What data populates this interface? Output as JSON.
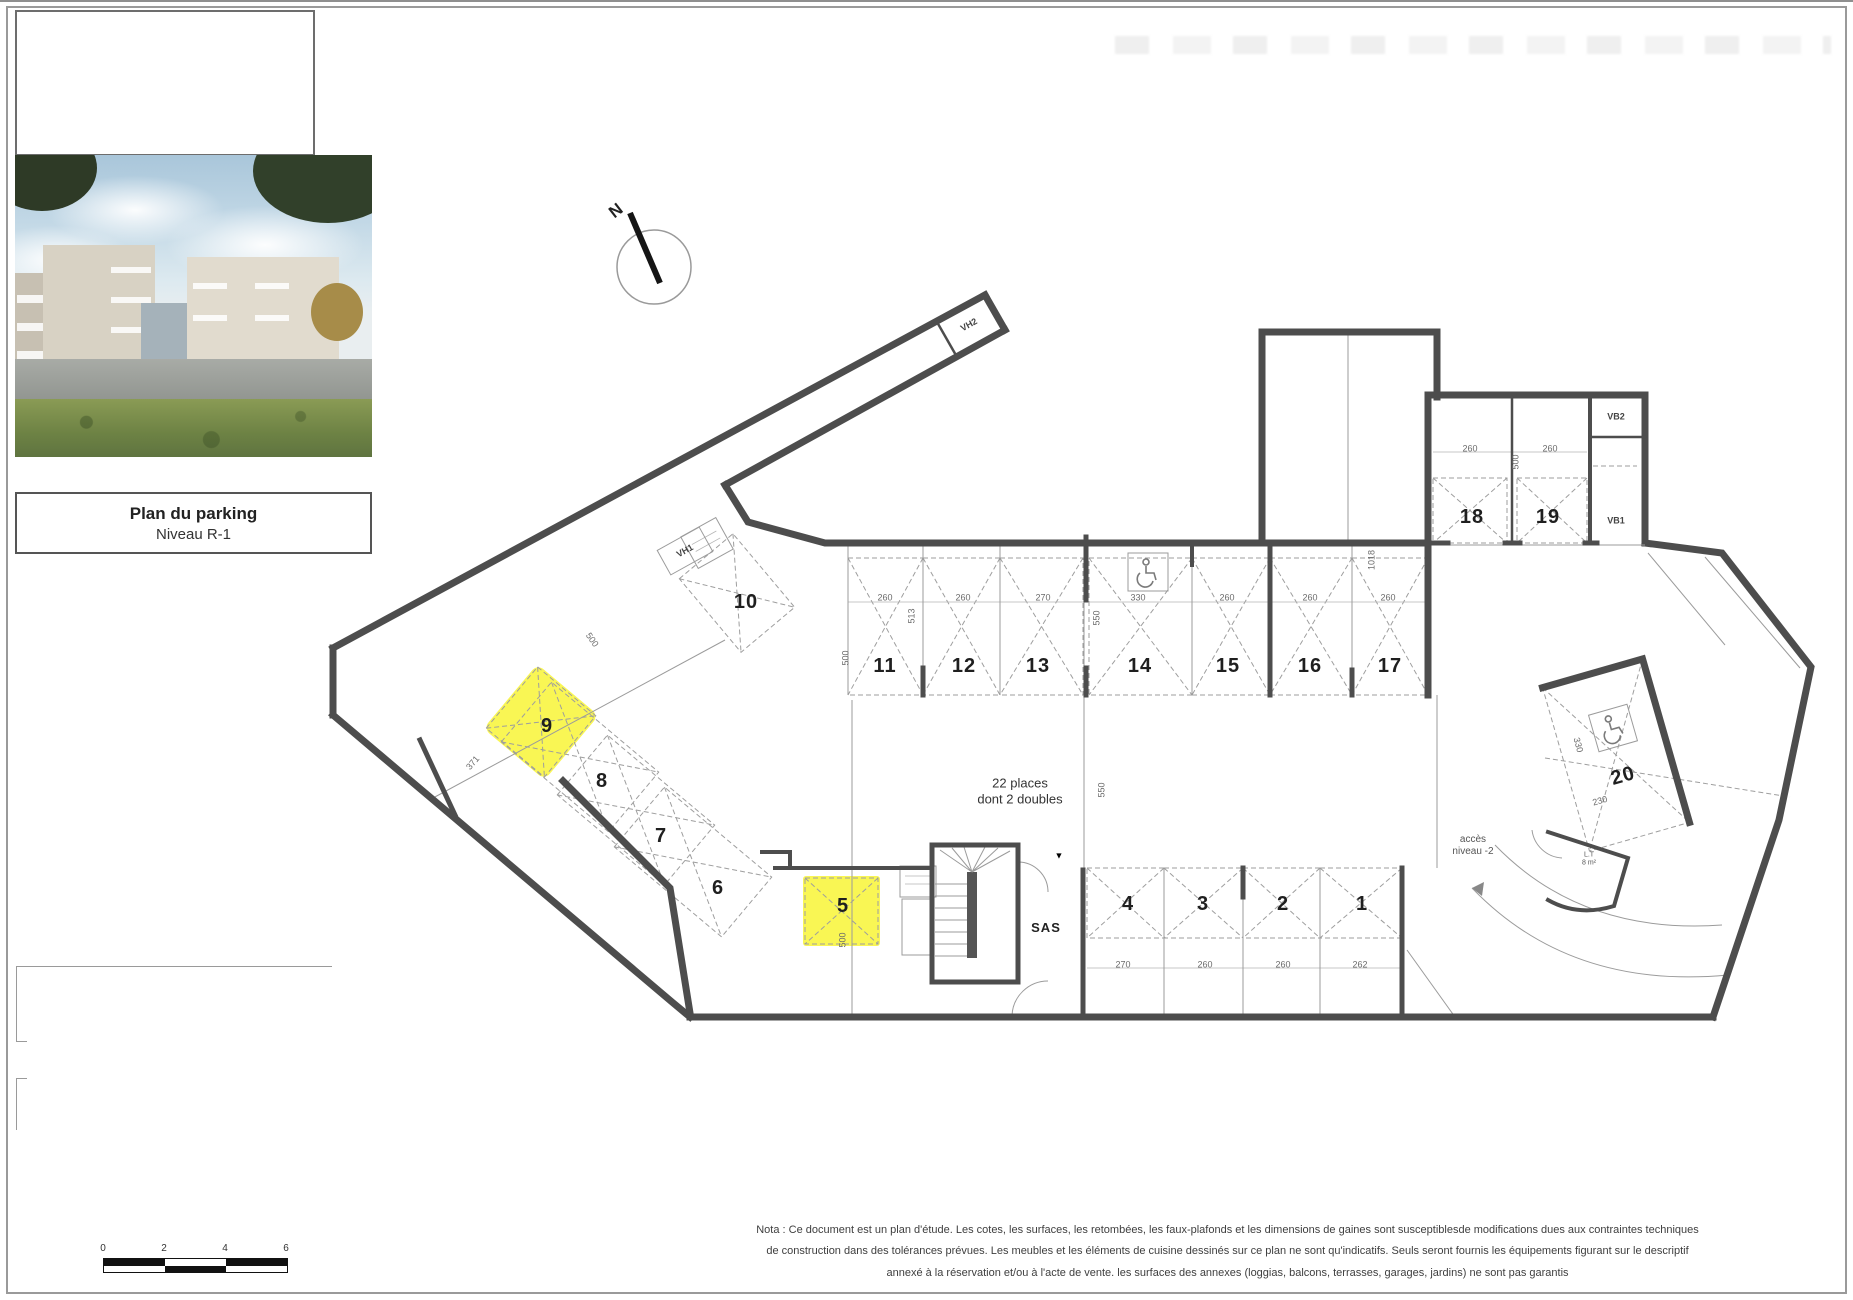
{
  "title_block": {
    "line1": "Plan du parking",
    "line2": "Niveau R-1"
  },
  "north": {
    "label": "N"
  },
  "plan": {
    "spaces": [
      {
        "t": "1",
        "x": 1362,
        "y": 904
      },
      {
        "t": "2",
        "x": 1283,
        "y": 904
      },
      {
        "t": "3",
        "x": 1203,
        "y": 904
      },
      {
        "t": "4",
        "x": 1128,
        "y": 904
      },
      {
        "t": "5",
        "x": 843,
        "y": 906
      },
      {
        "t": "6",
        "x": 718,
        "y": 888
      },
      {
        "t": "7",
        "x": 661,
        "y": 836
      },
      {
        "t": "8",
        "x": 602,
        "y": 781
      },
      {
        "t": "9",
        "x": 547,
        "y": 726
      },
      {
        "t": "10",
        "x": 746,
        "y": 602
      },
      {
        "t": "11",
        "x": 885,
        "y": 666
      },
      {
        "t": "12",
        "x": 964,
        "y": 666
      },
      {
        "t": "13",
        "x": 1038,
        "y": 666
      },
      {
        "t": "14",
        "x": 1140,
        "y": 666
      },
      {
        "t": "15",
        "x": 1228,
        "y": 666
      },
      {
        "t": "16",
        "x": 1310,
        "y": 666
      },
      {
        "t": "17",
        "x": 1390,
        "y": 666
      },
      {
        "t": "18",
        "x": 1472,
        "y": 517
      },
      {
        "t": "19",
        "x": 1548,
        "y": 517
      },
      {
        "t": "20",
        "x": 1623,
        "y": 776,
        "r": -16
      }
    ],
    "dims": [
      {
        "t": "260",
        "x": 885,
        "y": 598
      },
      {
        "t": "260",
        "x": 963,
        "y": 598
      },
      {
        "t": "270",
        "x": 1043,
        "y": 598
      },
      {
        "t": "330",
        "x": 1138,
        "y": 598
      },
      {
        "t": "260",
        "x": 1227,
        "y": 598
      },
      {
        "t": "260",
        "x": 1310,
        "y": 598
      },
      {
        "t": "260",
        "x": 1388,
        "y": 598
      },
      {
        "t": "270",
        "x": 1123,
        "y": 965
      },
      {
        "t": "260",
        "x": 1205,
        "y": 965
      },
      {
        "t": "260",
        "x": 1283,
        "y": 965
      },
      {
        "t": "262",
        "x": 1360,
        "y": 965
      },
      {
        "t": "260",
        "x": 1470,
        "y": 449
      },
      {
        "t": "260",
        "x": 1550,
        "y": 449
      },
      {
        "t": "513",
        "x": 912,
        "y": 616,
        "r": -90
      },
      {
        "t": "550",
        "x": 1097,
        "y": 618,
        "r": -90
      },
      {
        "t": "500",
        "x": 846,
        "y": 658,
        "r": -90
      },
      {
        "t": "550",
        "x": 1102,
        "y": 790,
        "r": -90
      },
      {
        "t": "1018",
        "x": 1372,
        "y": 560,
        "r": -90
      },
      {
        "t": "500",
        "x": 1516,
        "y": 462,
        "r": -90
      },
      {
        "t": "500",
        "x": 843,
        "y": 940,
        "r": -90
      },
      {
        "t": "371",
        "x": 473,
        "y": 763,
        "r": -50
      },
      {
        "t": "500",
        "x": 592,
        "y": 640,
        "r": 55
      },
      {
        "t": "330",
        "x": 1578,
        "y": 745,
        "r": 75
      },
      {
        "t": "230",
        "x": 1600,
        "y": 801,
        "r": -16
      }
    ],
    "tags": [
      {
        "t": "22 places\ndont 2 doubles",
        "x": 1020,
        "y": 791,
        "c": "cap"
      },
      {
        "t": "SAS",
        "x": 1046,
        "y": 928,
        "c": "sas"
      },
      {
        "t": "accès\nniveau -2",
        "x": 1473,
        "y": 846,
        "c": "tag2"
      },
      {
        "t": "L.T\n8 m²",
        "x": 1589,
        "y": 860,
        "c": "small"
      },
      {
        "t": "VH2",
        "x": 969,
        "y": 325,
        "r": -29,
        "c": "tag"
      },
      {
        "t": "VH1",
        "x": 685,
        "y": 551,
        "r": -29,
        "c": "tag"
      },
      {
        "t": "VB2",
        "x": 1616,
        "y": 417,
        "c": "tag"
      },
      {
        "t": "VB1",
        "x": 1616,
        "y": 521,
        "c": "tag"
      },
      {
        "t": "▼",
        "x": 1059,
        "y": 856,
        "c": "mark"
      }
    ]
  },
  "scale_bar": {
    "labels": [
      "0",
      "2",
      "4",
      "6"
    ]
  },
  "nota": {
    "line1": "Nota : Ce document est un plan d'étude. Les cotes, les surfaces, les retombées, les faux-plafonds et les dimensions de gaines sont susceptiblesde modifications  dues aux contraintes techniques",
    "line2": "de construction dans des tolérances  prévues. Les meubles et les éléments de cuisine dessinés sur ce plan ne sont qu'indicatifs. Seuls seront fournis les équipements figurant sur le descriptif",
    "line3": "annexé à la réservation et/ou à l'acte de vente. les surfaces des annexes (loggias, balcons, terrasses, garages, jardins) ne sont pas garantis"
  }
}
